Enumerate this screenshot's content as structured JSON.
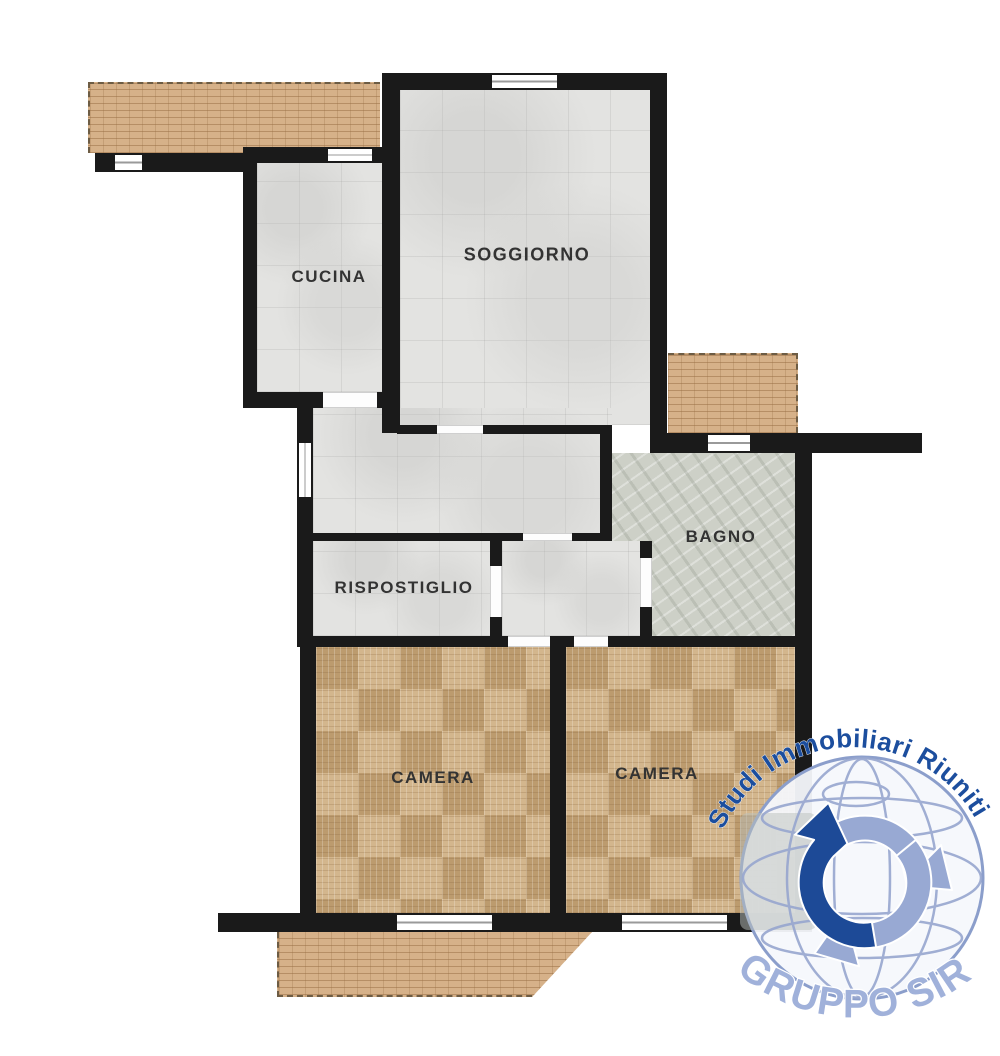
{
  "plan": {
    "rooms": [
      {
        "id": "cucina",
        "label": "CUCINA"
      },
      {
        "id": "soggiorno",
        "label": "SOGGIORNO"
      },
      {
        "id": "rispostiglio",
        "label": "RISPOSTIGLIO"
      },
      {
        "id": "bagno",
        "label": "BAGNO"
      },
      {
        "id": "camera_left",
        "label": "CAMERA"
      },
      {
        "id": "camera_right",
        "label": "CAMERA"
      }
    ]
  },
  "watermark": {
    "arc_text": "Studi Immobiliari Riuniti",
    "brand_text": "GRUPPO SIR"
  },
  "palette": {
    "wall": "#1a1a1a",
    "tile_floor": "#e3e3e1",
    "marble_floor": "#cdd0c7",
    "parquet_floor": "#c9ab81",
    "brick_terrace": "#d6b189",
    "watermark_dark_blue": "#1c4e9e",
    "watermark_light_blue": "#a0b1da",
    "globe_line": "#97a6cf",
    "label_text": "#333333"
  }
}
